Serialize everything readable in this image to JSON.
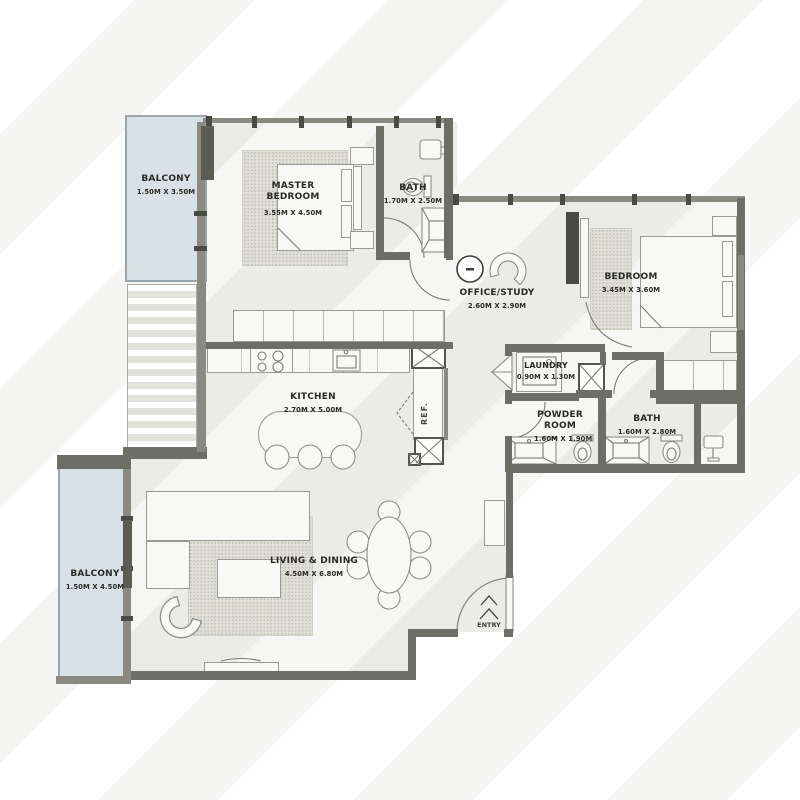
{
  "rooms": {
    "balcony_top": {
      "name": "BALCONY",
      "dims": "1.50M X 3.50M"
    },
    "master_bedroom": {
      "name": "MASTER BEDROOM",
      "dims": "3.55M X 4.50M"
    },
    "master_bath": {
      "name": "BATH",
      "dims": "1.70M X 2.50M"
    },
    "office_study": {
      "name": "OFFICE/STUDY",
      "dims": "2.60M X 2.90M"
    },
    "bedroom": {
      "name": "BEDROOM",
      "dims": "3.45M X 3.60M"
    },
    "laundry": {
      "name": "LAUNDRY",
      "dims": "0.90M X 1.30M"
    },
    "powder_room": {
      "name": "POWDER ROOM",
      "dims": "1.60M X 1.90M"
    },
    "bath": {
      "name": "BATH",
      "dims": "1.60M X 2.80M"
    },
    "kitchen": {
      "name": "KITCHEN",
      "dims": "2.70M X 5.00M"
    },
    "living_dining": {
      "name": "LIVING & DINING",
      "dims": "4.50M X 6.80M"
    },
    "balcony_bottom": {
      "name": "BALCONY",
      "dims": "1.50M X 4.50M"
    }
  },
  "annotations": {
    "ref": "REF.",
    "entry": "ENTRY"
  },
  "colors": {
    "wall": "#6E6E68",
    "window_wall": "#8A8A82",
    "floor": "#ECECE7",
    "balcony": "#D8E1E5",
    "text": "#2A2A24"
  }
}
